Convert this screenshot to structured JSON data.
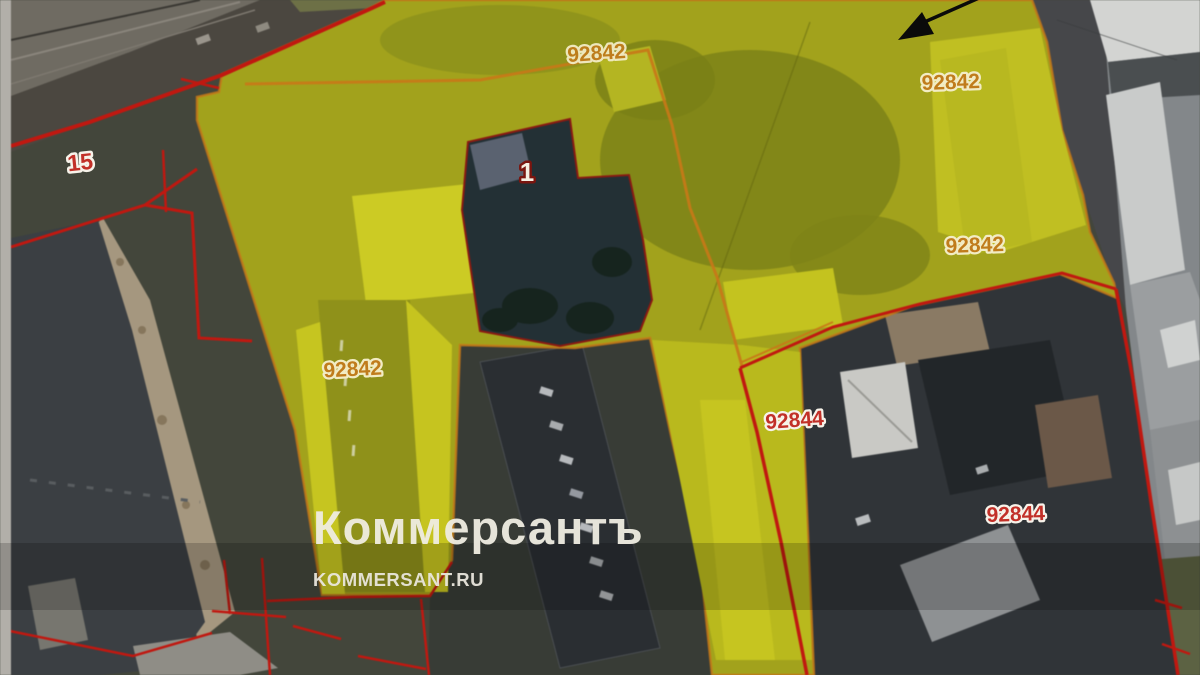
{
  "watermark": {
    "brand": "Коммерсантъ",
    "site": "KOMMERSANT.RU"
  },
  "map": {
    "type": "aerial-cadastral-map",
    "labels": {
      "parcel_15": "15",
      "parcel_1": "1",
      "quarter_top": "92842",
      "quarter_top_right": "92842",
      "quarter_right": "92842",
      "quarter_left": "92842",
      "parcel_92844_upper": "92844",
      "parcel_92844_lower": "92844"
    },
    "colors": {
      "highlight": "#a2a21c",
      "highlight_bright": "#c8c71f",
      "quarter_boundary": "#c87818",
      "parcel_boundary": "#c01810",
      "label_orange": "#c07c1c",
      "label_red": "#c23028",
      "label_halo": "#f5efcf",
      "parcel1_label": "#f5efe2",
      "arrow": "#0a0a0a",
      "watermark": "#f0ede2"
    }
  }
}
